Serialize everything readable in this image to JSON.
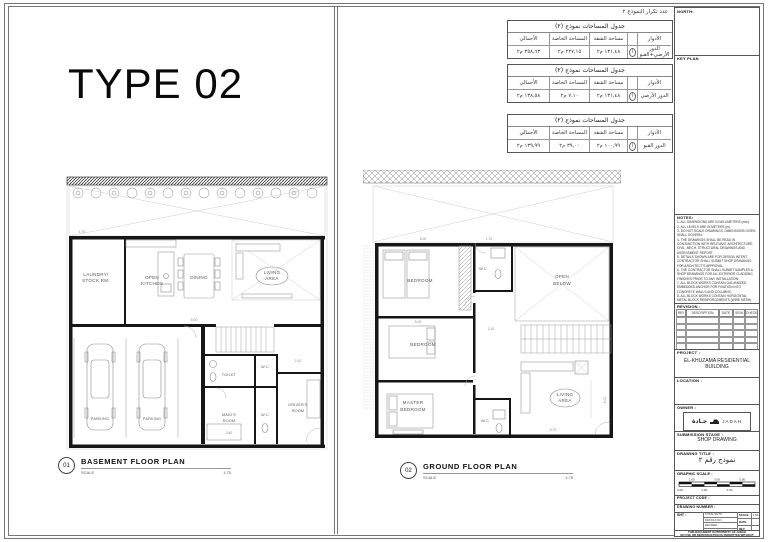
{
  "sheet_title": "TYPE 02",
  "repetition_note": "عدد تكرار النموذج ٢",
  "area_tables": {
    "headers": {
      "floor": "الأدوار",
      "apartment": "مساحة الشقة",
      "private": "المساحة الخاصة",
      "total": "الأجمالي"
    },
    "tables": [
      {
        "title": "جدول المساحات نموذج (٢)",
        "floor": "الدور الأرضي+القبو",
        "symbol": "أ",
        "apartment": "١٣١,٤٨ م٢",
        "private": "٢٢٧,١٥ م٢",
        "total": "٣٥٨,٦٣ م٢"
      },
      {
        "title": "جدول المساحات نموذج (٢)",
        "floor": "الدور الأرضي",
        "symbol": "أ",
        "apartment": "١٣١,٤٨ م٢",
        "private": "٧,١٠ م٢",
        "total": "١٣٨,٥٨ م٢"
      },
      {
        "title": "جدول المساحات نموذج (٢)",
        "floor": "الدور القبو",
        "symbol": "أ",
        "apartment": "١٠٠,٩٩ م٢",
        "private": "٣٩,٠٠ م٢",
        "total": "١٣٩,٩٩ م٢"
      }
    ]
  },
  "basement": {
    "labels": {
      "laundry1": "LAUNDRY/",
      "laundry2": "STOCK RM.",
      "kitchen1": "OPEN",
      "kitchen2": "KITCHEN",
      "dining": "DINING",
      "living1": "LIVING",
      "living2": "AREA",
      "wc_small": "W.C",
      "toilet": "TOILET",
      "maids1": "MAID'S",
      "maids2": "ROOM",
      "wc": "W.C",
      "drivers1": "DRIVER'S",
      "drivers2": "ROOM",
      "parking": "PARKING"
    },
    "dims": {
      "d1": "1.70",
      "d2": "5.00",
      "d3": "3.40",
      "d4": "2.10"
    },
    "title_num": "01",
    "title": "BASEMENT FLOOR PLAN",
    "scale_label": "SCALE",
    "scale_value": "1:75"
  },
  "ground": {
    "labels": {
      "bedroom1": "BEDROOM",
      "wc_top": "W.C",
      "open1": "OPEN",
      "open2": "BELOW",
      "bedroom2": "BEDROOM",
      "master1": "MASTER",
      "master2": "BEDROOM",
      "wc_bottom": "W.C",
      "living1": "LIVING",
      "living2": "AREA"
    },
    "dims": {
      "d1": "5.00",
      "d2": "1.70",
      "d3": "5.00",
      "d4": "2.10",
      "d5": "5.70",
      "d6": "4.00"
    },
    "title_num": "02",
    "title": "GROUND FLOOR PLAN",
    "scale_label": "SCALE",
    "scale_value": "1:75"
  },
  "titleblock": {
    "north_label": "NORTH:",
    "keyplan_label": "KEY PLAN",
    "notes_label": "NOTES:",
    "notes": [
      "1- ALL DIMENSIONS ARE IN MILLIMETERS (mm).",
      "2- ALL LEVELS ARE IN METERS (m).",
      "3- DO NOT SCALE DRAWINGS, DIMENSIONS GIVEN SHALL GOVERN.",
      "4- THE DRAWINGS SHALL BE READ IN CONJUNCTION WITH RELEVANT ARCHITECTURE, CIVIL, MECH, STRUCTURAL DRAWINGS AND ASSESSMENT REPORT.",
      "5- DETAILS SHOWN ARE FOR DESIGN INTENT, CONTRACTOR SHALL SUBMIT SHOP DRAWINGS FOR ARCHITECT'S APPROVAL.",
      "6- THE CONTRACTOR SHALL SUBMIT SAMPLES & SHOP DRAWINGS FOR ALL EXTERIOR CLADDING FINISHES PRIOR TO ANY INSTALLATION.",
      "7- ALL BLOCK WORKS CONTAIN GALVANIZED EMBEDDED ANCHOR FOR FIXATION INTO CONCRETE WALLS AND COLUMNS.",
      "8- ALL BLOCK WORKS CONTAIN HORIZONTAL METAL BLOCK REINFORCEMENTS (WIRE MESH).",
      "9- ALL BLOCK WORKS CONTAIN PLASTERMENT ITEMS (ANGLE BEAD, PLASTER STOP, ARCHITRAVE EDGE, MOVEMENT BEAD, EXPANDED METAL LATH...).",
      "10- ALL BLOCK WALLS BETWEEN THE JOINTS AND THE STONE CORRIDOR SHALL BE FIRE RESISTANT."
    ],
    "notes_footer": "ALL 00 LEVEL EQUAL (000.00) IN NATURAL LEVEL",
    "revision_label": "REVISION :",
    "rev_headers": [
      "REV",
      "DESCRIPTION",
      "DATE",
      "SIGN",
      "CHECK"
    ],
    "project_label": "PROJECT :",
    "project_value": "EL-KHUZAMA RESIDENTIAL BUILDING",
    "location_label": "LOCATION :",
    "owner_label": "OWNER :",
    "owner_logo_ar": "جـادة",
    "owner_logo_en": "JADAH",
    "submission_label": "SUBMISSION STAGE :",
    "submission_value": "SHOP DRAWING",
    "drawing_title_label": "DRAWING TITLE :",
    "drawing_title_value": "نموذج رقم ٢",
    "graphic_scale_label": "GRAPHIC SCALE :",
    "scale_top": [
      "1.00",
      "3.00",
      "5.00"
    ],
    "scale_bottom": [
      "0.00",
      "2.00",
      "4.00"
    ],
    "project_code_label": "PROJECT CODE :",
    "drawing_number_label": "DRAWING NUMBER :",
    "sht_label": "SHT :",
    "info_left": [
      "TOTAL SHTS :",
      "DETAILS NO :",
      "REVISED :",
      "APPROVED :"
    ],
    "info_right_labels": [
      "SCALE",
      "DATE",
      "REV"
    ],
    "info_right_values": [
      "1:50",
      "",
      ""
    ],
    "footer1": "THIS DOCUMENT IS PROPERTY OF JADAH",
    "footer2": "NO USE OR REPRODUCTION IS PERMITTED WITHOUT WRITTEN PERMISSION"
  }
}
